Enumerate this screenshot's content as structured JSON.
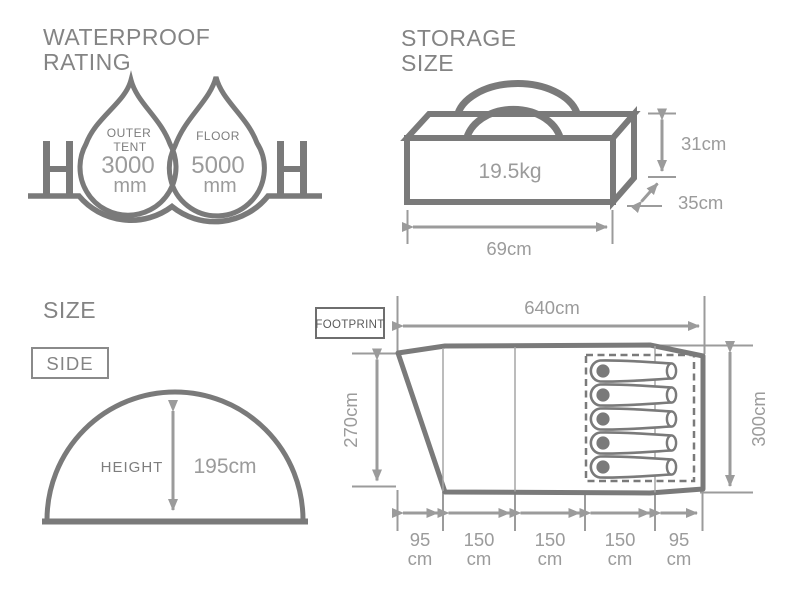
{
  "colors": {
    "line": "#7a7a7a",
    "dim": "#9b9b9b",
    "title": "#848484",
    "label": "#7d7d7d",
    "dark": "#5a5a5a",
    "thin": "#a6a6a6"
  },
  "waterproof": {
    "title_line1": "WATERPROOF",
    "title_line2": "RATING",
    "outer_tent": {
      "label_line1": "OUTER",
      "label_line2": "TENT",
      "value": "3000",
      "unit": "mm"
    },
    "floor": {
      "label": "FLOOR",
      "value": "5000",
      "unit": "mm"
    }
  },
  "storage": {
    "title_line1": "STORAGE",
    "title_line2": "SIZE",
    "weight": "19.5kg",
    "height": "31cm",
    "depth": "35cm",
    "width": "69cm"
  },
  "size": {
    "title": "SIZE",
    "view_label": "SIDE",
    "height_label": "HEIGHT",
    "height_value": "195cm"
  },
  "footprint": {
    "label": "FOOTPRINT",
    "length": "640cm",
    "left_width": "270cm",
    "right_width": "300cm",
    "sleeper_count": 5,
    "segments": [
      {
        "value": "95",
        "unit": "cm"
      },
      {
        "value": "150",
        "unit": "cm"
      },
      {
        "value": "150",
        "unit": "cm"
      },
      {
        "value": "150",
        "unit": "cm"
      },
      {
        "value": "95",
        "unit": "cm"
      }
    ]
  }
}
